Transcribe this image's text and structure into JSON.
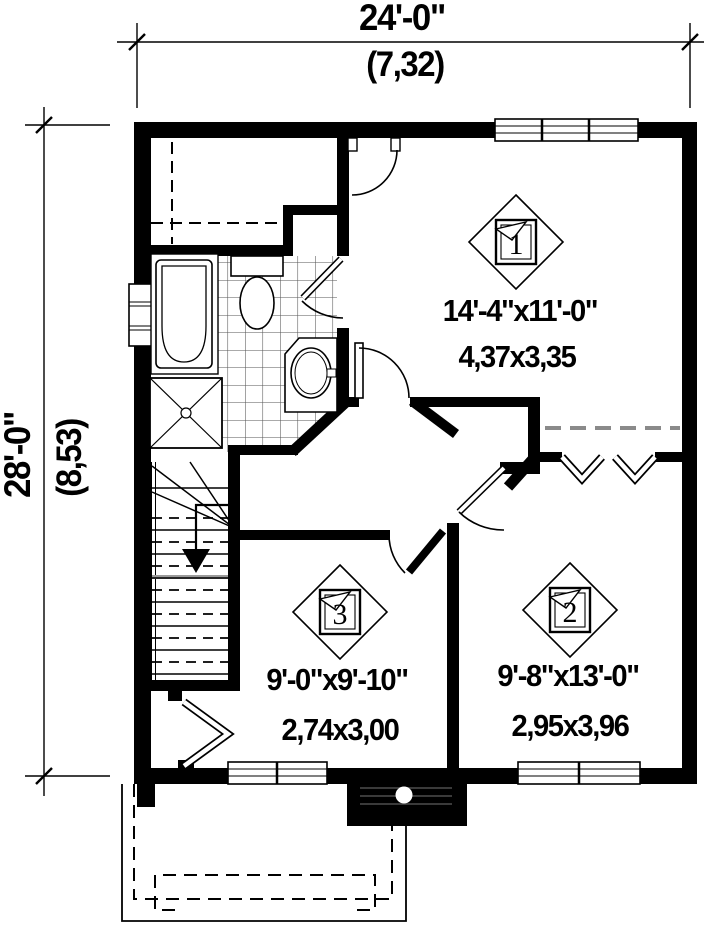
{
  "title": "Floor plan",
  "dimensions": {
    "top": {
      "imperial": "24'-0\"",
      "metric": "(7,32)"
    },
    "left": {
      "imperial": "28'-0\"",
      "metric": "(8,53)"
    }
  },
  "rooms": [
    {
      "tag": "1",
      "imperial": "14'-4\"x11'-0\"",
      "metric": "4,37x3,35"
    },
    {
      "tag": "2",
      "imperial": "9'-8\"x13'-0\"",
      "metric": "2,95x3,96"
    },
    {
      "tag": "3",
      "imperial": "9'-0\"x9'-10\"",
      "metric": "2,74x3,00"
    }
  ],
  "colors": {
    "wall": "#000000",
    "background": "#ffffff",
    "shelf": "#8a8a8a",
    "tile": "#555555"
  }
}
